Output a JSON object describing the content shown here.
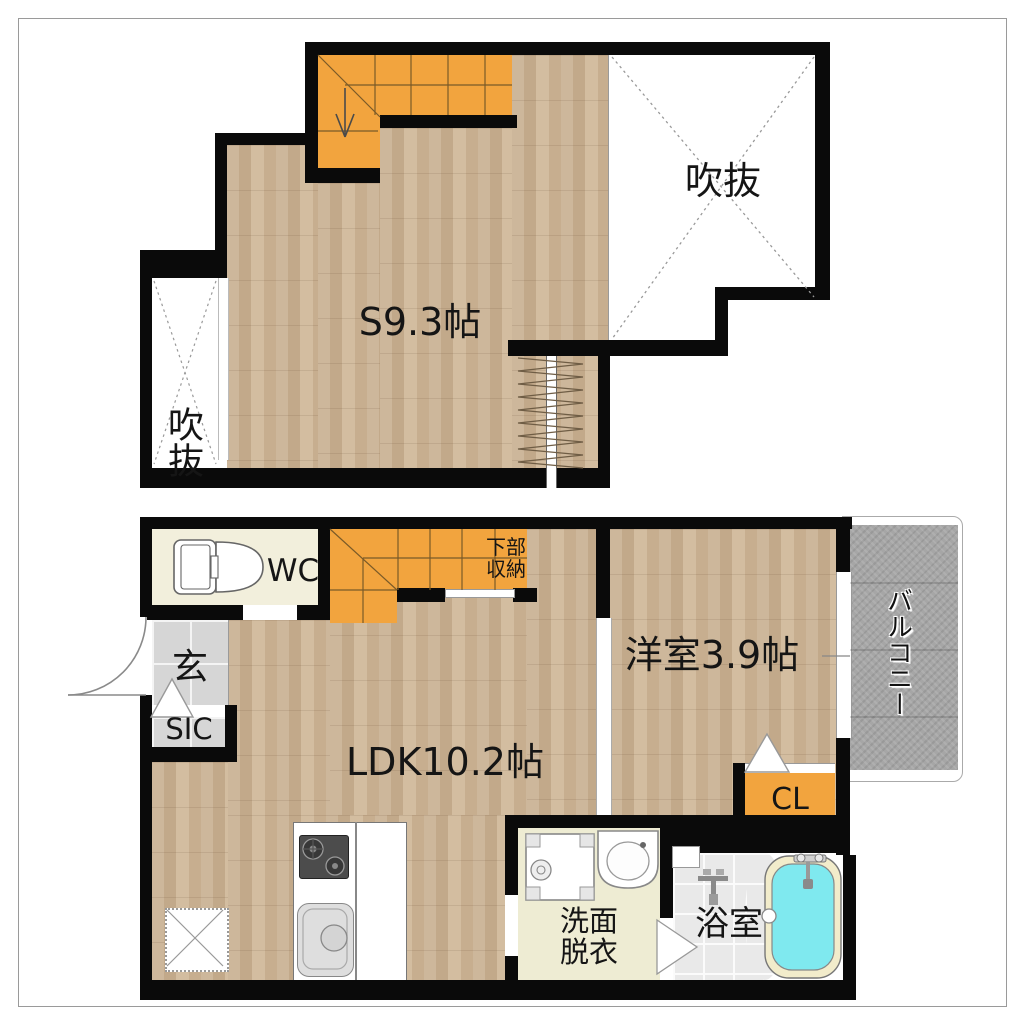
{
  "page": {
    "type": "japanese-apartment-floor-plan"
  },
  "colors": {
    "wall": "#0a0a0a",
    "wood_floor": "#cab295",
    "stair_orange": "#f2a43e",
    "closet_orange": "#f2a43e",
    "entry_tile": "#d6d6d6",
    "balcony_gray": "#a6a6a6",
    "wc_floor": "#f2efdc",
    "washroom_floor": "#eeecd3",
    "bath_tile": "#e9e9e9",
    "bath_water": "#7fe9ef",
    "tub_rim": "#f2eccb"
  },
  "floor2": {
    "room_label": "S9.3帖",
    "void_right_label": "吹抜",
    "void_left_label": "吹抜"
  },
  "floor1": {
    "wc_label": "WC",
    "entrance_label": "玄",
    "shoe_closet_label": "SIC",
    "ldk_label": "LDK10.2帖",
    "understair_storage_line1": "下部",
    "understair_storage_line2": "収納",
    "bedroom_label": "洋室3.9帖",
    "closet_label": "CL",
    "washroom_line1": "洗面",
    "washroom_line2": "脱衣",
    "bath_label": "浴室",
    "balcony_label": "バルコニー"
  }
}
